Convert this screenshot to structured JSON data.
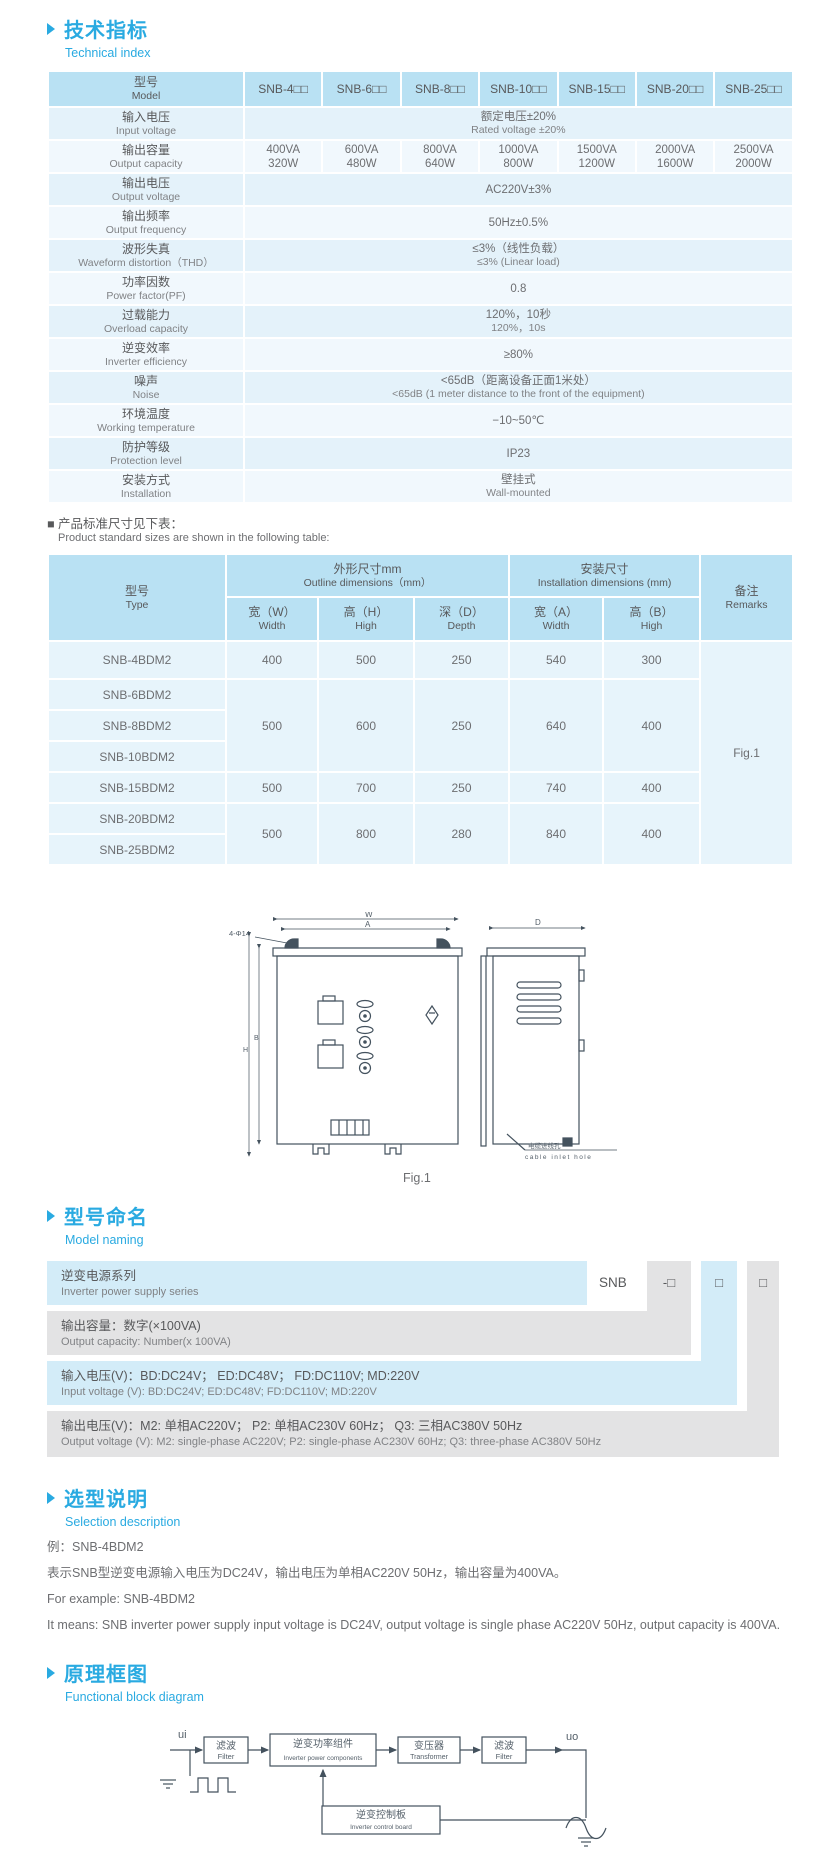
{
  "sections": {
    "technical": {
      "title_zh": "技术指标",
      "title_en": "Technical index"
    },
    "model_naming": {
      "title_zh": "型号命名",
      "title_en": "Model naming"
    },
    "selection": {
      "title_zh": "选型说明",
      "title_en": "Selection description"
    },
    "block_diagram": {
      "title_zh": "原理框图",
      "title_en": "Functional block diagram"
    }
  },
  "colors": {
    "accent": "#29aae1",
    "table_header": "#b9e1f3",
    "row_blue": "#e4f2fa",
    "naming_blue": "#d3ecf8",
    "naming_gray": "#e3e3e4",
    "line_art": "#44525e"
  },
  "spec_table": {
    "model_label_zh": "型号",
    "model_label_en": "Model",
    "models": [
      "SNB-4□□",
      "SNB-6□□",
      "SNB-8□□",
      "SNB-10□□",
      "SNB-15□□",
      "SNB-20□□",
      "SNB-25□□"
    ],
    "rows": [
      {
        "zh": "输入电压",
        "en": "Input voltage",
        "v1": "额定电压±20%",
        "v2": "Rated voltage ±20%"
      },
      {
        "zh": "输出容量",
        "en": "Output capacity",
        "va": [
          "400VA",
          "600VA",
          "800VA",
          "1000VA",
          "1500VA",
          "2000VA",
          "2500VA"
        ],
        "watts": [
          "320W",
          "480W",
          "640W",
          "800W",
          "1200W",
          "1600W",
          "2000W"
        ]
      },
      {
        "zh": "输出电压",
        "en": "Output voltage",
        "v1": "AC220V±3%"
      },
      {
        "zh": "输出频率",
        "en": "Output frequency",
        "v1": "50Hz±0.5%"
      },
      {
        "zh": "波形失真",
        "en": "Waveform distortion（THD）",
        "v1": "≤3%（线性负载）",
        "v2": "≤3% (Linear load)"
      },
      {
        "zh": "功率因数",
        "en": "Power factor(PF)",
        "v1": "0.8"
      },
      {
        "zh": "过载能力",
        "en": "Overload capacity",
        "v1": "120%，10秒",
        "v2": "120%，10s"
      },
      {
        "zh": "逆变效率",
        "en": "Inverter efficiency",
        "v1": "≥80%"
      },
      {
        "zh": "噪声",
        "en": "Noise",
        "v1": "<65dB（距离设备正面1米处）",
        "v2": "<65dB (1 meter distance to the front of the equipment)"
      },
      {
        "zh": "环境温度",
        "en": "Working temperature",
        "v1": "−10~50℃"
      },
      {
        "zh": "防护等级",
        "en": "Protection level",
        "v1": "IP23"
      },
      {
        "zh": "安装方式",
        "en": "Installation",
        "v1": "壁挂式",
        "v2": "Wall-mounted"
      }
    ]
  },
  "size_note": {
    "zh": "■ 产品标准尺寸见下表：",
    "en": "Product standard sizes are shown in the following table:"
  },
  "size_table": {
    "type_zh": "型号",
    "type_en": "Type",
    "outline_zh": "外形尺寸mm",
    "outline_en": "Outline dimensions（mm）",
    "install_zh": "安装尺寸",
    "install_en": "Installation dimensions (mm)",
    "remarks_zh": "备注",
    "remarks_en": "Remarks",
    "cols": [
      {
        "zh": "宽（W）",
        "en": "Width"
      },
      {
        "zh": "高（H）",
        "en": "High"
      },
      {
        "zh": "深（D）",
        "en": "Depth"
      },
      {
        "zh": "宽（A）",
        "en": "Width"
      },
      {
        "zh": "高（B）",
        "en": "High"
      }
    ],
    "rows": [
      {
        "type": "SNB-4BDM2"
      },
      {
        "type": "SNB-6BDM2"
      },
      {
        "type": "SNB-8BDM2"
      },
      {
        "type": "SNB-10BDM2"
      },
      {
        "type": "SNB-15BDM2"
      },
      {
        "type": "SNB-20BDM2"
      },
      {
        "type": "SNB-25BDM2"
      }
    ],
    "groups": [
      {
        "w": "400",
        "h": "500",
        "d": "250",
        "a": "540",
        "b": "300"
      },
      {
        "w": "500",
        "h": "600",
        "d": "250",
        "a": "640",
        "b": "400"
      },
      {
        "w": "500",
        "h": "700",
        "d": "250",
        "a": "740",
        "b": "400"
      },
      {
        "w": "500",
        "h": "800",
        "d": "280",
        "a": "840",
        "b": "400"
      }
    ],
    "remark_value": "Fig.1"
  },
  "figure": {
    "caption": "Fig.1",
    "dim_w": "W",
    "dim_a": "A",
    "dim_d": "D",
    "dim_h": "H",
    "dim_b": "B",
    "holes_label": "4-Φ14",
    "cable_zh": "电缆进线孔",
    "cable_en": "cable inlet hole"
  },
  "naming": {
    "series_code": "SNB",
    "placeholder_dash": "-□",
    "placeholder": "□",
    "rows": [
      {
        "zh": "逆变电源系列",
        "en": "Inverter power supply series"
      },
      {
        "zh": "输出容量：数字(×100VA)",
        "en": "Output capacity: Number(x 100VA)"
      },
      {
        "zh": "输入电压(V)：BD:DC24V； ED:DC48V； FD:DC110V; MD:220V",
        "en": "Input voltage (V): BD:DC24V;  ED:DC48V;  FD:DC110V; MD:220V"
      },
      {
        "zh": "输出电压(V)：M2: 单相AC220V； P2: 单相AC230V 60Hz； Q3: 三相AC380V 50Hz",
        "en": "Output voltage (V):  M2: single-phase AC220V;  P2: single-phase AC230V 60Hz;  Q3: three-phase AC380V 50Hz"
      }
    ]
  },
  "selection": {
    "lines": [
      "例：SNB-4BDM2",
      "表示SNB型逆变电源输入电压为DC24V，输出电压为单相AC220V 50Hz，输出容量为400VA。",
      "For example: SNB-4BDM2",
      "It means: SNB inverter power supply input voltage is DC24V, output voltage is single phase AC220V 50Hz, output capacity is 400VA."
    ]
  },
  "diagram": {
    "ui": "ui",
    "uo": "uo",
    "filter_zh": "滤波",
    "filter_en": "Filter",
    "inverter_zh": "逆变功率组件",
    "inverter_en": "Inverter power components",
    "transformer_zh": "变压器",
    "transformer_en": "Transformer",
    "control_zh": "逆变控制板",
    "control_en": "Inverter control board"
  }
}
